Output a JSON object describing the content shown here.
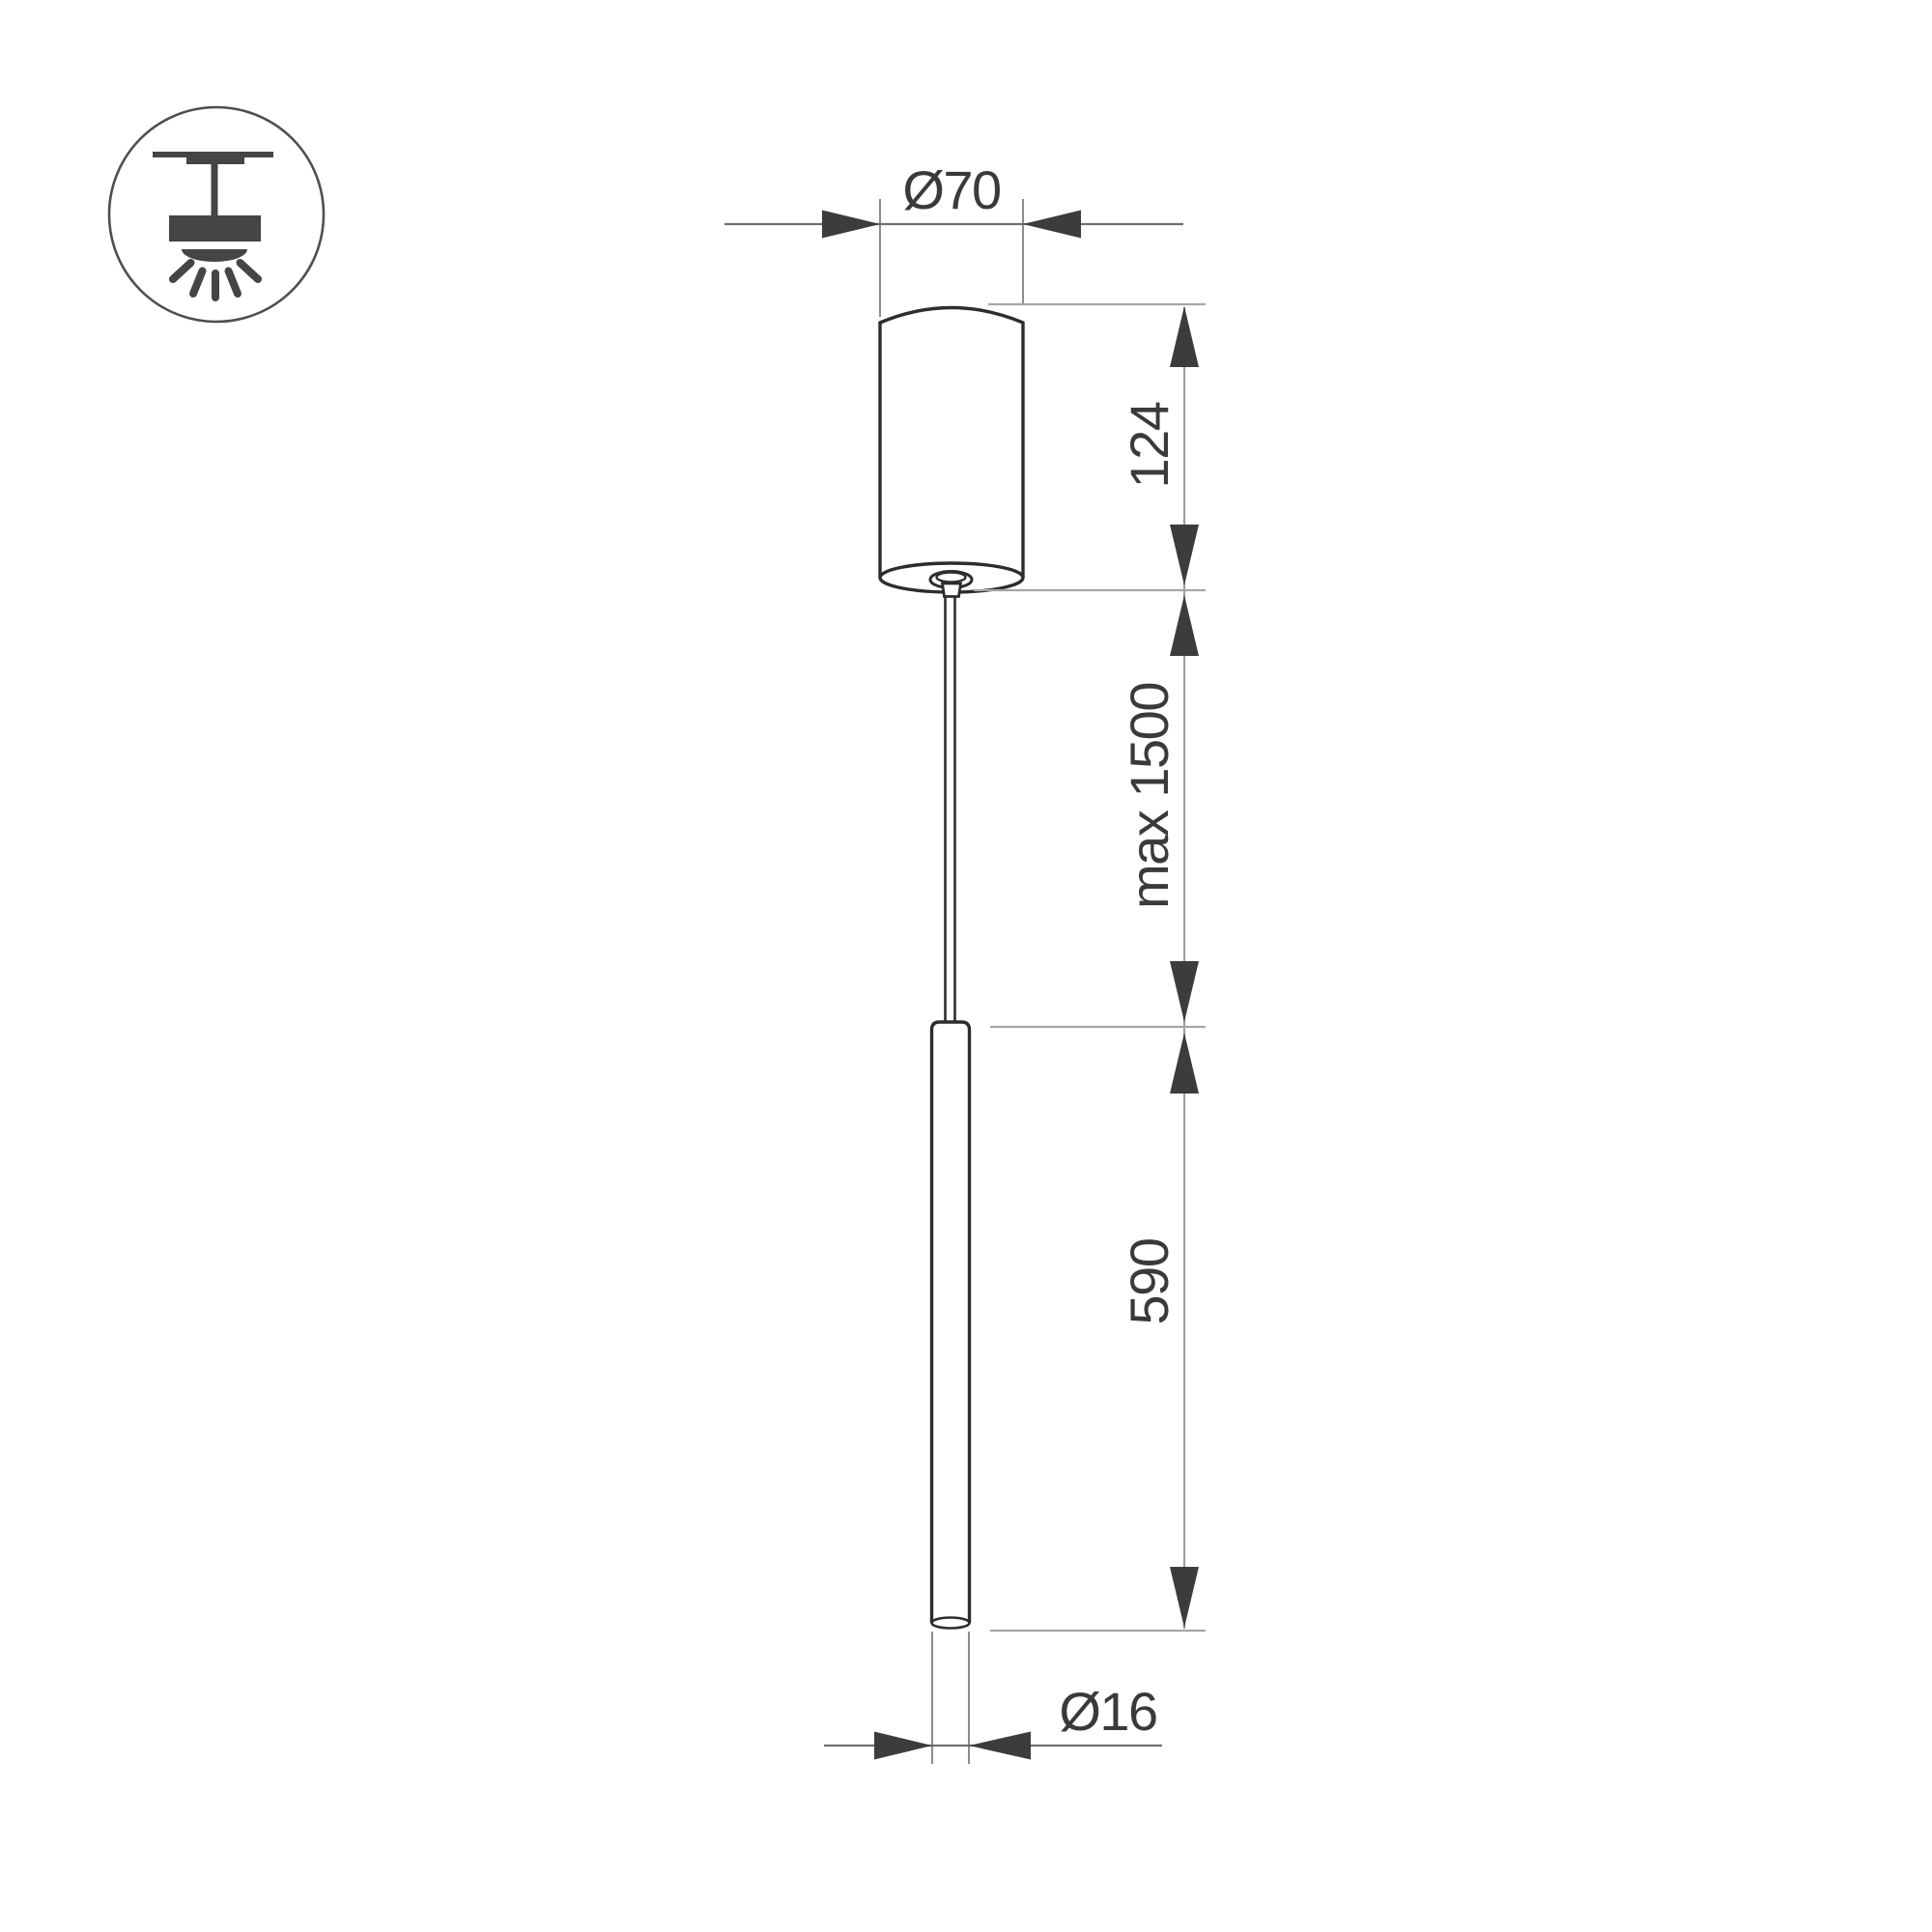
{
  "legend_icon": {
    "name": "ceiling-pendant-mount-icon",
    "description": "surface ceiling mount pendant light glyph in circle"
  },
  "labels": {
    "canopy_diameter": "Ø70",
    "canopy_height": "124",
    "suspension_length": "max 1500",
    "tube_length": "590",
    "tube_diameter": "Ø16"
  },
  "colors": {
    "background": "#ffffff",
    "outline": "#2d2d2d",
    "extension_line": "#8c8c8c",
    "dimension_line": "#6f6f6f",
    "chain_line": "#9e9e9e",
    "reference_line": "#a6a6a6",
    "arrow": "#3c3c3e",
    "text": "#3a3a3a",
    "icon_glyph": "#454545",
    "icon_circle_stroke": "#4f4f4f"
  }
}
